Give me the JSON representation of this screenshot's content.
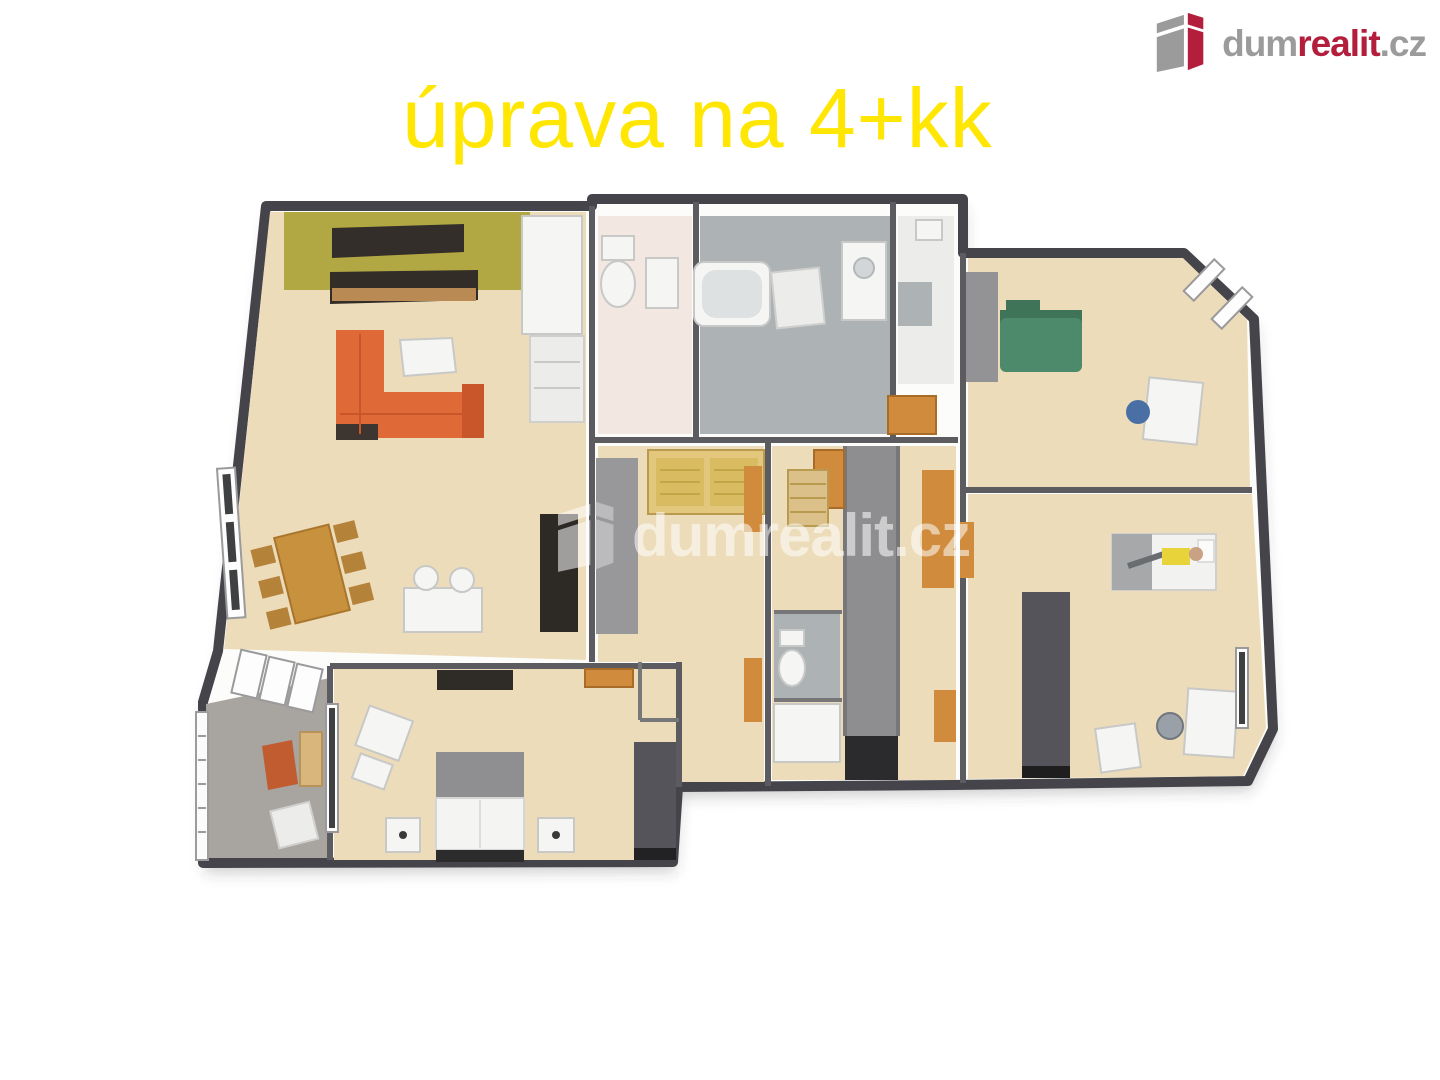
{
  "title": {
    "text": "úprava na 4+kk",
    "color": "#ffe603"
  },
  "logo": {
    "dum": "dum",
    "realit": "realit",
    "tld": ".cz",
    "gray": "#9b9b9b",
    "red": "#b31e3c",
    "icon": "dumrealit-building-icon"
  },
  "watermark": {
    "text": "dumrealit.cz",
    "color": "#ffffff",
    "opacity": 0.55,
    "icon": "dumrealit-building-icon"
  },
  "floorplan": {
    "type": "3d-rendered-floorplan",
    "palette": {
      "wallFill": "#fcfcfb",
      "outerWall": "#44444a",
      "innerWall": "#5c5c60",
      "wood": "#ecdcba",
      "balcony": "#a8a49f",
      "tile": "#adb2b4",
      "wcFloor": "#f2e7e1",
      "olive": "#b2a843",
      "sofaOrange": "#df6a38",
      "cabinetOrange": "#d08b3d",
      "tan": "#e3c77c",
      "green": "#4d8a6b",
      "darkFurn": "#332e29",
      "closet": "#8e8e90",
      "darkWardrobe": "#54545a",
      "white": "#f4f4f2",
      "blue": "#4a6fa5",
      "yellow": "#e8d43a"
    },
    "rooms": [
      {
        "name": "living-room-with-kitchen"
      },
      {
        "name": "balcony"
      },
      {
        "name": "master-bedroom"
      },
      {
        "name": "wc"
      },
      {
        "name": "bathroom"
      },
      {
        "name": "shower-room"
      },
      {
        "name": "entry-hall"
      },
      {
        "name": "corridor-walk-in-closet"
      },
      {
        "name": "bedroom-top-right"
      },
      {
        "name": "bedroom-right"
      }
    ]
  }
}
